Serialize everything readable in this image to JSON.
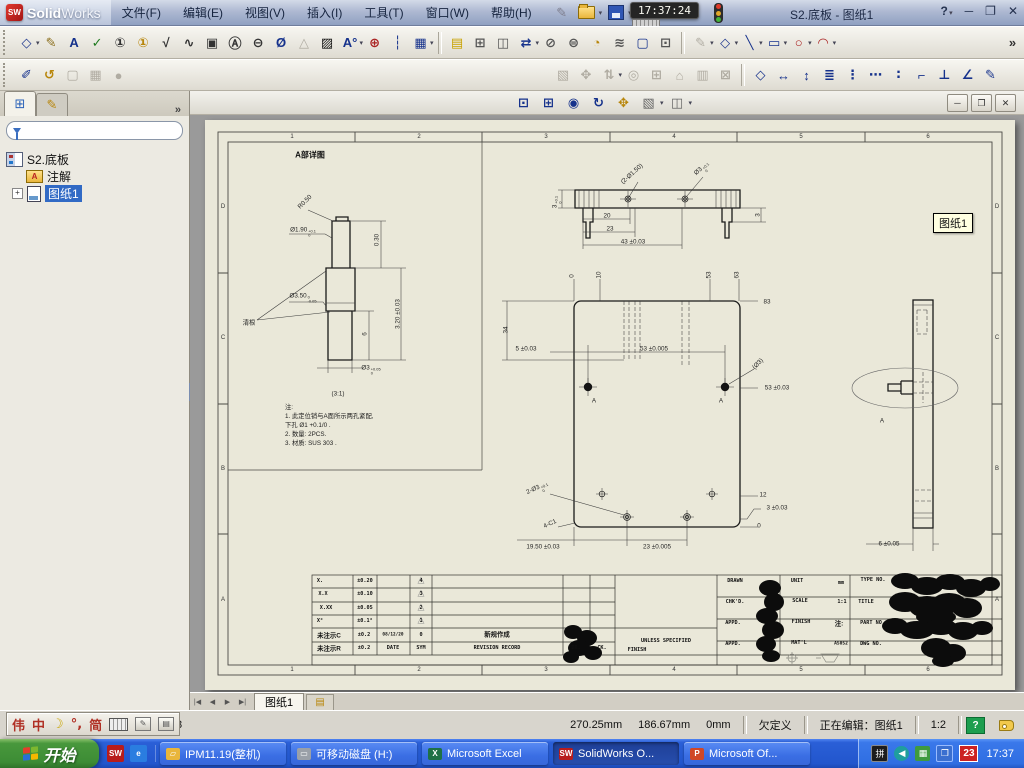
{
  "titlebar": {
    "logo_sw": "SW",
    "logo_solid": "Solid",
    "logo_works": "Works",
    "menus": [
      "文件(F)",
      "编辑(E)",
      "视图(V)",
      "插入(I)",
      "工具(T)",
      "窗口(W)",
      "帮助(H)"
    ],
    "clock": "17:37:24",
    "doc_title": "S2.底板 - 图纸1",
    "help_label": "?",
    "minimize": "─",
    "restore": "❐",
    "close": "✕"
  },
  "toolbars": {
    "row2_left": [
      {
        "n": "smart-dimension-icon",
        "g": "◇",
        "c": "#223a8f",
        "dd": true
      },
      {
        "n": "model-items-icon",
        "g": "✎",
        "c": "#8a6d1a"
      },
      {
        "n": "note-icon",
        "g": "A",
        "c": "#16328c"
      },
      {
        "n": "spell-check-icon",
        "g": "✓",
        "c": "#1f7a1f"
      },
      {
        "n": "balloon-icon",
        "g": "①",
        "c": "#333"
      },
      {
        "n": "auto-balloon-icon",
        "g": "①",
        "c": "#b8860b"
      },
      {
        "n": "surface-finish-icon",
        "g": "√",
        "c": "#333"
      },
      {
        "n": "weld-symbol-icon",
        "g": "∿",
        "c": "#333"
      },
      {
        "n": "geometric-tolerance-icon",
        "g": "▣",
        "c": "#333"
      },
      {
        "n": "datum-feature-icon",
        "g": "Ⓐ",
        "c": "#333"
      },
      {
        "n": "datum-target-icon",
        "g": "⊖",
        "c": "#333"
      },
      {
        "n": "hole-callout-icon",
        "g": "Ø",
        "c": "#16328c"
      },
      {
        "n": "revision-symbol-icon",
        "g": "△",
        "c": "#999",
        "off": true
      },
      {
        "n": "area-hatch-icon",
        "g": "▨",
        "c": "#111"
      },
      {
        "n": "block-icon",
        "g": "A°",
        "c": "#16328c",
        "dd": true
      },
      {
        "n": "center-mark-icon",
        "g": "⊕",
        "c": "#a22"
      },
      {
        "n": "centerline-icon",
        "g": "┆",
        "c": "#16328c"
      },
      {
        "n": "table-icon",
        "g": "▦",
        "c": "#16328c",
        "dd": true
      },
      {
        "sep": true
      },
      {
        "n": "design-binder-icon",
        "g": "▤",
        "c": "#c8a200"
      }
    ],
    "row2_right": [
      {
        "n": "standard-3-view-icon",
        "g": "⊞",
        "c": "#555"
      },
      {
        "n": "model-view-icon",
        "g": "◫",
        "c": "#555"
      },
      {
        "n": "projected-view-icon",
        "g": "⇄",
        "c": "#16328c",
        "dd": true
      },
      {
        "n": "section-view-icon",
        "g": "⊘",
        "c": "#555"
      },
      {
        "n": "aligned-section-icon",
        "g": "⊜",
        "c": "#555"
      },
      {
        "n": "detail-view-icon",
        "g": "◔",
        "c": "#b8860b"
      },
      {
        "n": "broken-view-icon",
        "g": "≋",
        "c": "#555"
      },
      {
        "n": "break-view-icon",
        "g": "▢",
        "c": "#16328c"
      },
      {
        "n": "crop-view-icon",
        "g": "⊡",
        "c": "#555"
      },
      {
        "sep": true
      },
      {
        "n": "sketch-icon",
        "g": "✎",
        "c": "#999",
        "dd": true,
        "off": true
      },
      {
        "n": "sketch-dimension-icon",
        "g": "◇",
        "c": "#223a8f",
        "dd": true
      },
      {
        "n": "line-icon",
        "g": "╲",
        "c": "#16328c",
        "dd": true
      },
      {
        "n": "rectangle-icon",
        "g": "▭",
        "c": "#16328c",
        "dd": true
      },
      {
        "n": "circle-icon",
        "g": "○",
        "c": "#a22",
        "dd": true
      },
      {
        "n": "arc-icon",
        "g": "◠",
        "c": "#a22",
        "dd": true
      },
      {
        "spacer": true
      },
      {
        "n": "toolbar-overflow-icon",
        "g": "»",
        "c": "#333"
      }
    ],
    "row3_left": [
      {
        "n": "verify-icon",
        "g": "✐",
        "c": "#16328c"
      },
      {
        "n": "rebuild-icon",
        "g": "↺",
        "c": "#b8860b"
      },
      {
        "n": "shaded-view-icon",
        "g": "▢",
        "c": "#aaa",
        "off": true
      },
      {
        "n": "drawing-mode-icon",
        "g": "▦",
        "c": "#aaa",
        "off": true
      },
      {
        "n": "render-icon",
        "g": "●",
        "c": "#bbb",
        "off": true
      }
    ],
    "row3_right": [
      {
        "n": "insert-components-icon",
        "g": "▧",
        "c": "#aaa",
        "off": true
      },
      {
        "n": "mate-icon",
        "g": "✥",
        "c": "#aaa",
        "off": true
      },
      {
        "n": "rotate-component-icon",
        "g": "⇅",
        "c": "#aaa",
        "off": true,
        "dd": true
      },
      {
        "n": "move-component-icon",
        "g": "◎",
        "c": "#aaa",
        "off": true
      },
      {
        "n": "smart-fasteners-icon",
        "g": "⊞",
        "c": "#aaa",
        "off": true
      },
      {
        "n": "exploded-view-icon",
        "g": "⌂",
        "c": "#aaa",
        "off": true
      },
      {
        "n": "interference-icon",
        "g": "▥",
        "c": "#aaa",
        "off": true
      },
      {
        "n": "assembly-features-icon",
        "g": "⊠",
        "c": "#aaa",
        "off": true
      },
      {
        "sep": true
      },
      {
        "n": "dim-smart-icon",
        "g": "◇",
        "c": "#16328c"
      },
      {
        "n": "dim-horizontal-icon",
        "g": "↔",
        "c": "#16328c"
      },
      {
        "n": "dim-vertical-icon",
        "g": "↕",
        "c": "#16328c"
      },
      {
        "n": "dim-baseline-icon",
        "g": "≣",
        "c": "#16328c"
      },
      {
        "n": "dim-ordinate-icon",
        "g": "⋮",
        "c": "#16328c"
      },
      {
        "n": "dim-horizontal-ordinate-icon",
        "g": "⋯",
        "c": "#16328c"
      },
      {
        "n": "dim-vertical-ordinate-icon",
        "g": "∶",
        "c": "#16328c"
      },
      {
        "n": "dim-chamfer-icon",
        "g": "⌐",
        "c": "#16328c"
      },
      {
        "n": "dim-perpendicular-icon",
        "g": "⊥",
        "c": "#16328c"
      },
      {
        "n": "dim-angular-icon",
        "g": "∠",
        "c": "#16328c"
      },
      {
        "n": "autodimension-icon",
        "g": "✎",
        "c": "#16328c"
      }
    ],
    "doc": [
      {
        "n": "zoom-to-fit-icon",
        "g": "⊡",
        "c": "#16328c"
      },
      {
        "n": "zoom-to-area-icon",
        "g": "⊞",
        "c": "#16328c"
      },
      {
        "n": "zoom-to-selection-icon",
        "g": "◉",
        "c": "#16328c"
      },
      {
        "n": "rotate-view-icon",
        "g": "↻",
        "c": "#16328c"
      },
      {
        "n": "pan-icon",
        "g": "✥",
        "c": "#b8860b"
      },
      {
        "n": "view-orientation-icon",
        "g": "▧",
        "c": "#666",
        "dd": true
      },
      {
        "n": "display-style-icon",
        "g": "◫",
        "c": "#666",
        "dd": true
      }
    ]
  },
  "sidebar": {
    "chevron": "»",
    "root": "S2.底板",
    "items": [
      {
        "label": "注解"
      },
      {
        "label": "图纸1",
        "selected": true
      }
    ],
    "expander": "+"
  },
  "doc_window": {
    "minimize": "─",
    "restore": "❐",
    "close": "✕"
  },
  "sheet_tabs": {
    "nav": [
      "|◀",
      "◀",
      "▶",
      "▶|"
    ],
    "active": "图纸1"
  },
  "tooltip": "图纸1",
  "ime": {
    "items": [
      "伟",
      "中",
      "☽",
      "°,",
      "简"
    ]
  },
  "statusbar": {
    "leftover": "8",
    "x": "270.25mm",
    "y": "186.67mm",
    "z": "0mm",
    "state": "欠定义",
    "editing": "正在编辑：图纸1",
    "scale": "1:2",
    "help": "?"
  },
  "taskbar": {
    "start": "开始",
    "quick": [
      {
        "n": "quicklaunch-solidworks-icon",
        "g": "SW",
        "c": "#b81c1c"
      },
      {
        "n": "quicklaunch-ie-icon",
        "g": "e",
        "c": "#2a7de0"
      }
    ],
    "tasks": [
      {
        "label": "IPM11.19(整机)",
        "icon": "folder",
        "active": false
      },
      {
        "label": "可移动磁盘 (H:)",
        "icon": "drive",
        "active": false
      },
      {
        "label": "Microsoft Excel",
        "icon": "excel",
        "active": false
      },
      {
        "label": "SolidWorks O...",
        "icon": "sw",
        "active": true
      },
      {
        "label": "Microsoft Of...",
        "icon": "ppt",
        "active": false
      }
    ],
    "tray": {
      "date": "23",
      "time": "17:37"
    }
  },
  "sheet": {
    "zones_h": [
      "1",
      "2",
      "3",
      "4",
      "5",
      "6"
    ],
    "zones_v": [
      "D",
      "C",
      "B",
      "A"
    ],
    "notes": [
      "注:",
      "1. 此定位销与A面所示两孔紧配,",
      "    下孔 Ø1 +0.1/0 .",
      "2. 数量: 2PCS.",
      "3. 材质: SUS 303 ."
    ],
    "annotations": [
      {
        "t": "A部详图",
        "x": 105,
        "y": 35,
        "k": "vt"
      },
      {
        "t": "R0.50",
        "x": 100,
        "y": 82,
        "r": -45
      },
      {
        "t": "Ø1.90",
        "tol": "+0.1|0",
        "x": 98,
        "y": 112
      },
      {
        "t": "0.30",
        "x": 172,
        "y": 120,
        "r": -90
      },
      {
        "t": "Ø3.50",
        "tol": "0|-0.05",
        "x": 98,
        "y": 178
      },
      {
        "t": "6",
        "x": 160,
        "y": 214,
        "r": -90
      },
      {
        "t": "3.20 ±0.03",
        "x": 193,
        "y": 194,
        "r": -90
      },
      {
        "t": "清根",
        "x": 44,
        "y": 202
      },
      {
        "t": "Ø3",
        "tol": "+0.05|0",
        "x": 166,
        "y": 250
      },
      {
        "t": "(3:1)",
        "x": 133,
        "y": 274
      },
      {
        "t": "(2-Ø1.50)",
        "x": 427,
        "y": 54,
        "r": -42
      },
      {
        "t": "Ø3",
        "tol": "+0.1|0",
        "x": 498,
        "y": 50,
        "r": -42
      },
      {
        "t": "3",
        "tol": "+0.1|0",
        "x": 352,
        "y": 82,
        "r": -90
      },
      {
        "t": "20",
        "x": 402,
        "y": 96
      },
      {
        "t": "23",
        "x": 405,
        "y": 109
      },
      {
        "t": "43 ±0.03",
        "x": 428,
        "y": 122
      },
      {
        "t": "3",
        "x": 553,
        "y": 95,
        "r": -90
      },
      {
        "t": "0",
        "x": 367,
        "y": 156,
        "r": -90
      },
      {
        "t": "10",
        "x": 394,
        "y": 155,
        "r": -90
      },
      {
        "t": "53",
        "x": 504,
        "y": 155,
        "r": -90
      },
      {
        "t": "63",
        "x": 532,
        "y": 155,
        "r": -90
      },
      {
        "t": "83",
        "x": 562,
        "y": 182
      },
      {
        "t": "53 ±0.03",
        "x": 572,
        "y": 268
      },
      {
        "t": "12",
        "x": 558,
        "y": 375
      },
      {
        "t": "3 ±0.03",
        "x": 572,
        "y": 388
      },
      {
        "t": "0",
        "x": 554,
        "y": 406
      },
      {
        "t": "34",
        "x": 301,
        "y": 210,
        "r": -90
      },
      {
        "t": "5 ±0.03",
        "x": 321,
        "y": 229
      },
      {
        "t": "53 ±0.005",
        "x": 449,
        "y": 229
      },
      {
        "t": "(Ø3)",
        "x": 553,
        "y": 244,
        "r": -45
      },
      {
        "t": "A",
        "x": 389,
        "y": 281
      },
      {
        "t": "A",
        "x": 516,
        "y": 281
      },
      {
        "t": "2-Ø3",
        "tol": "+0.1|0",
        "x": 333,
        "y": 370,
        "r": -25
      },
      {
        "t": "4-C1",
        "x": 345,
        "y": 404,
        "r": -25
      },
      {
        "t": "19.50 ±0.03",
        "x": 338,
        "y": 427
      },
      {
        "t": "23 ±0.005",
        "x": 452,
        "y": 427
      },
      {
        "t": "A",
        "x": 677,
        "y": 301
      },
      {
        "t": "6 ±0.05",
        "x": 684,
        "y": 424
      },
      {
        "t": "X.",
        "x": 115,
        "y": 461,
        "k": "tb"
      },
      {
        "t": "X.X",
        "x": 118,
        "y": 474,
        "k": "tb"
      },
      {
        "t": "X.XX",
        "x": 121,
        "y": 488,
        "k": "tb"
      },
      {
        "t": "X°",
        "x": 115,
        "y": 501,
        "k": "tb"
      },
      {
        "t": "未注示C",
        "x": 124,
        "y": 515,
        "k": "tbc"
      },
      {
        "t": "未注示R",
        "x": 124,
        "y": 528,
        "k": "tbc"
      },
      {
        "t": "±0.20",
        "x": 160,
        "y": 461,
        "k": "tb"
      },
      {
        "t": "±0.10",
        "x": 160,
        "y": 474,
        "k": "tb"
      },
      {
        "t": "±0.05",
        "x": 160,
        "y": 488,
        "k": "tb"
      },
      {
        "t": "±0.1°",
        "x": 160,
        "y": 501,
        "k": "tb"
      },
      {
        "t": "±0.2",
        "x": 159,
        "y": 515,
        "k": "tb"
      },
      {
        "t": "±0.2",
        "x": 159,
        "y": 528,
        "k": "tb"
      },
      {
        "t": "08/12/20",
        "x": 188,
        "y": 515,
        "k": "tb",
        "fs": 4.4
      },
      {
        "t": "DATE",
        "x": 188,
        "y": 528,
        "k": "tb"
      },
      {
        "t": "△",
        "x": 216,
        "y": 460,
        "fs": 9,
        "c": "#8f8f8f"
      },
      {
        "t": "△",
        "x": 216,
        "y": 473,
        "fs": 9,
        "c": "#8f8f8f"
      },
      {
        "t": "△",
        "x": 216,
        "y": 487,
        "fs": 9,
        "c": "#8f8f8f"
      },
      {
        "t": "△",
        "x": 216,
        "y": 500,
        "fs": 9,
        "c": "#8f8f8f"
      },
      {
        "t": "4",
        "x": 216,
        "y": 461,
        "k": "tb"
      },
      {
        "t": "3",
        "x": 216,
        "y": 474,
        "k": "tb"
      },
      {
        "t": "2",
        "x": 216,
        "y": 488,
        "k": "tb"
      },
      {
        "t": "1",
        "x": 216,
        "y": 501,
        "k": "tb"
      },
      {
        "t": "0",
        "x": 216,
        "y": 515,
        "k": "tb"
      },
      {
        "t": "SYM",
        "x": 216,
        "y": 528,
        "k": "tb"
      },
      {
        "t": "新规作成",
        "x": 292,
        "y": 514,
        "k": "tbc"
      },
      {
        "t": "REVISION RECORD",
        "x": 292,
        "y": 528,
        "k": "tb"
      },
      {
        "t": "DR.",
        "x": 371,
        "y": 528,
        "k": "tb"
      },
      {
        "t": "CK.",
        "x": 397,
        "y": 528,
        "k": "tb"
      },
      {
        "t": "UNLESS SPECIFIED",
        "x": 461,
        "y": 521,
        "k": "tb"
      },
      {
        "t": "FINISH",
        "x": 432,
        "y": 530,
        "k": "tb"
      },
      {
        "t": "DRAWN",
        "x": 530,
        "y": 461,
        "k": "tb"
      },
      {
        "t": "CHK'D.",
        "x": 530,
        "y": 482,
        "k": "tb"
      },
      {
        "t": "APPD.",
        "x": 528,
        "y": 503,
        "k": "tb"
      },
      {
        "t": "APPD.",
        "x": 528,
        "y": 524,
        "k": "tb"
      },
      {
        "t": "UNIT",
        "x": 592,
        "y": 461,
        "k": "tb"
      },
      {
        "t": "SCALE",
        "x": 595,
        "y": 481,
        "k": "tb"
      },
      {
        "t": "FINISH",
        "x": 596,
        "y": 502,
        "k": "tb"
      },
      {
        "t": "MAT'L",
        "x": 594,
        "y": 523,
        "k": "tb"
      },
      {
        "t": "mm",
        "x": 636,
        "y": 463,
        "k": "tb"
      },
      {
        "t": "1:1",
        "x": 637,
        "y": 482,
        "k": "tb"
      },
      {
        "t": "注:",
        "x": 634,
        "y": 503,
        "k": "tbc"
      },
      {
        "t": "A5052",
        "x": 636,
        "y": 524,
        "k": "tb",
        "fs": 4.6
      },
      {
        "t": "TYPE NO.",
        "x": 668,
        "y": 460,
        "k": "tb"
      },
      {
        "t": "TITLE",
        "x": 661,
        "y": 482,
        "k": "tb"
      },
      {
        "t": "PART NO",
        "x": 666,
        "y": 503,
        "k": "tb"
      },
      {
        "t": "DWG NO.",
        "x": 666,
        "y": 524,
        "k": "tb"
      }
    ]
  }
}
